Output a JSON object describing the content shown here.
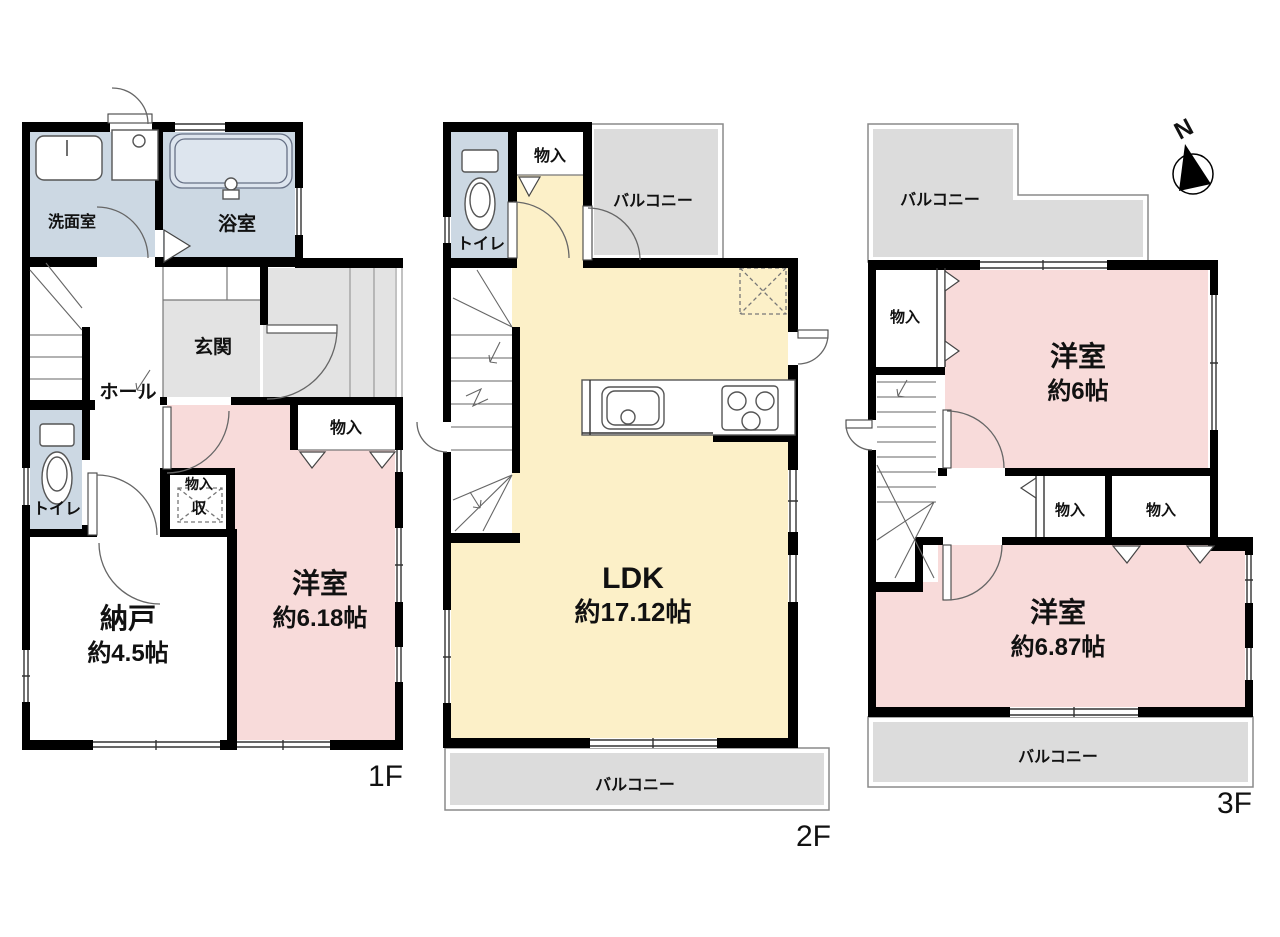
{
  "compass": {
    "north_label": "N"
  },
  "colors": {
    "wall": "#000000",
    "wet_room_blue": "#ccd8e3",
    "tatami_pink": "#f8dbda",
    "ldk_yellow": "#fcf0c8",
    "balcony_gray": "#dcdcdc",
    "entrance_gray": "#e3e3e3"
  },
  "floors": [
    {
      "label": "1F",
      "rooms": {
        "washroom": "洗面室",
        "bathroom": "浴室",
        "entrance": "玄関",
        "hall": "ホール",
        "toilet": "トイレ",
        "closet_top": "物入",
        "closet_small": "物入",
        "closet_small_inner": "収",
        "storage_name": "納戸",
        "storage_size": "約4.5帖",
        "western_name": "洋室",
        "western_size": "約6.18帖"
      }
    },
    {
      "label": "2F",
      "rooms": {
        "toilet": "トイレ",
        "closet": "物入",
        "balcony_top": "バルコニー",
        "ldk_name": "LDK",
        "ldk_size": "約17.12帖",
        "balcony_bottom": "バルコニー"
      }
    },
    {
      "label": "3F",
      "rooms": {
        "balcony_top": "バルコニー",
        "closet_a": "物入",
        "western1_name": "洋室",
        "western1_size": "約6帖",
        "closet_b": "物入",
        "closet_c": "物入",
        "western2_name": "洋室",
        "western2_size": "約6.87帖",
        "balcony_bottom": "バルコニー"
      }
    }
  ]
}
